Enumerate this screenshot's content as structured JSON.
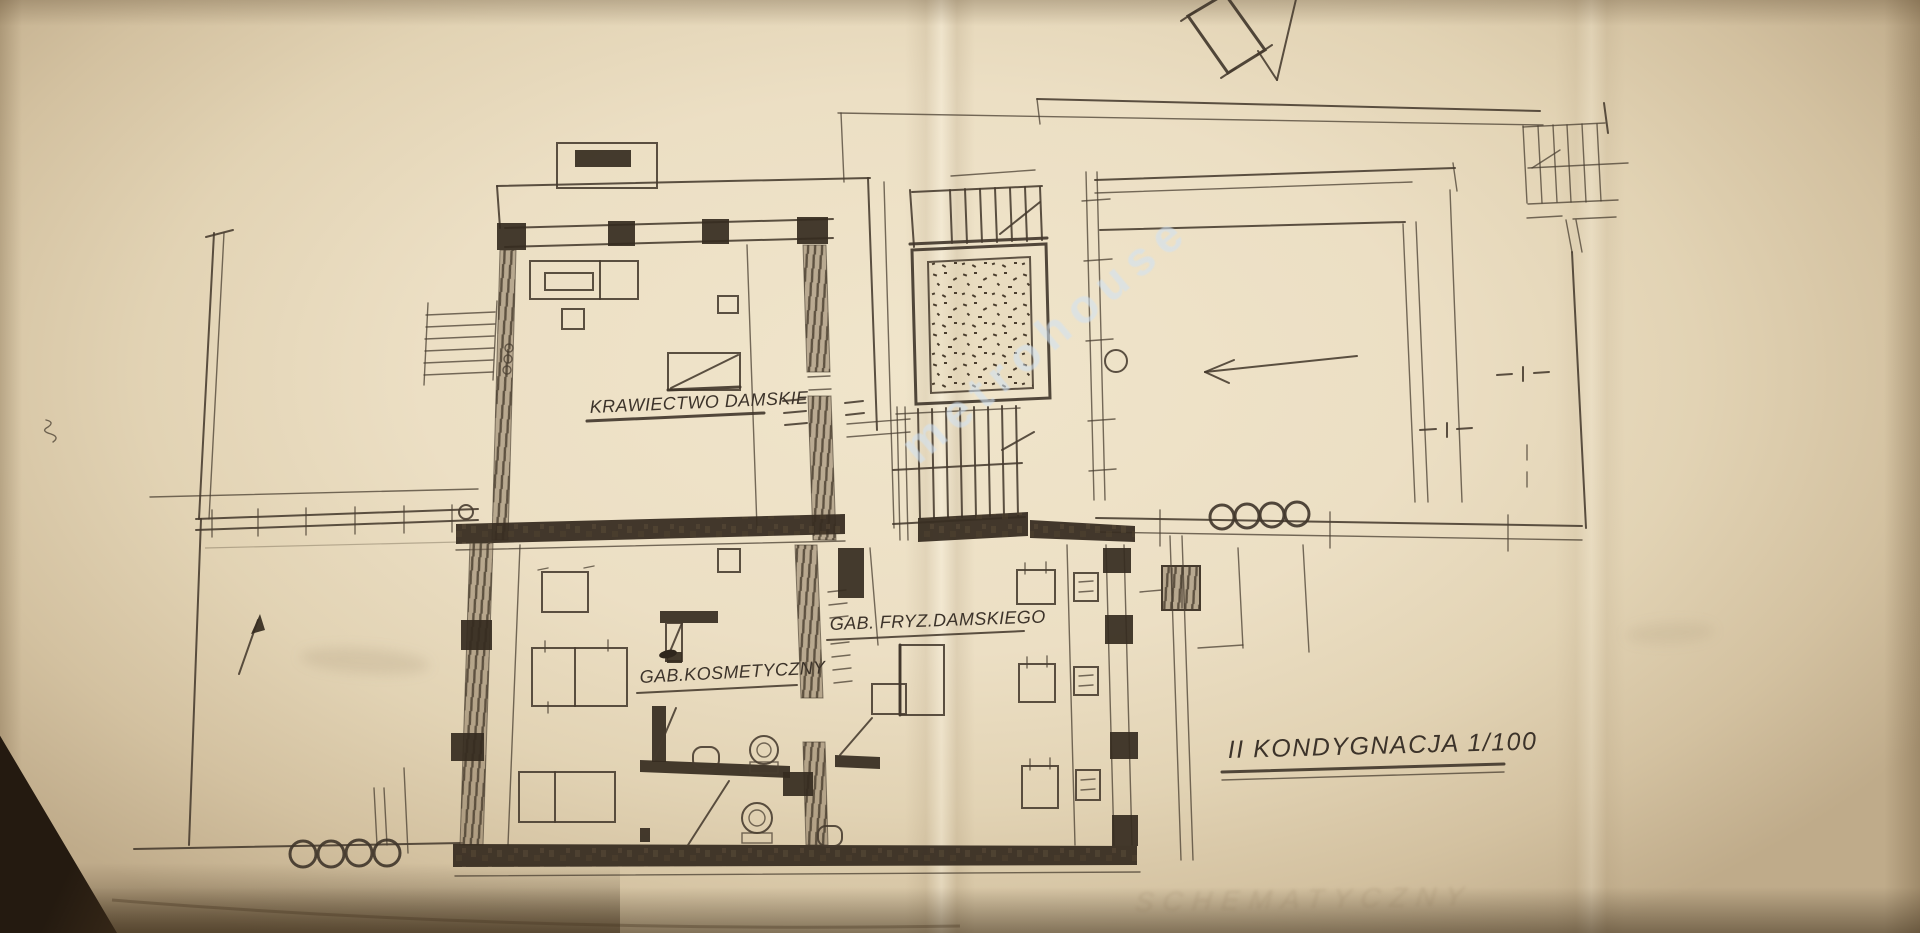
{
  "drawing": {
    "floor_label": "II KONDYGNACJA 1/100",
    "scale": "1/100",
    "room_labels": {
      "tailoring": "KRAWIECTWO DAMSKIE",
      "hairdresser": "GAB. FRYZ.DAMSKIEGO",
      "cosmetics": "GAB.KOSMETYCZNY"
    },
    "watermark": "metrohouse",
    "bleed_through_text": "SCHEMATYCZNY",
    "colors": {
      "paper": "#ecdfc4",
      "ink": "#453a2d",
      "wall_fill": "#352b20",
      "watermark_color": "#d0e2f3",
      "table_shadow": "#241a10"
    }
  }
}
